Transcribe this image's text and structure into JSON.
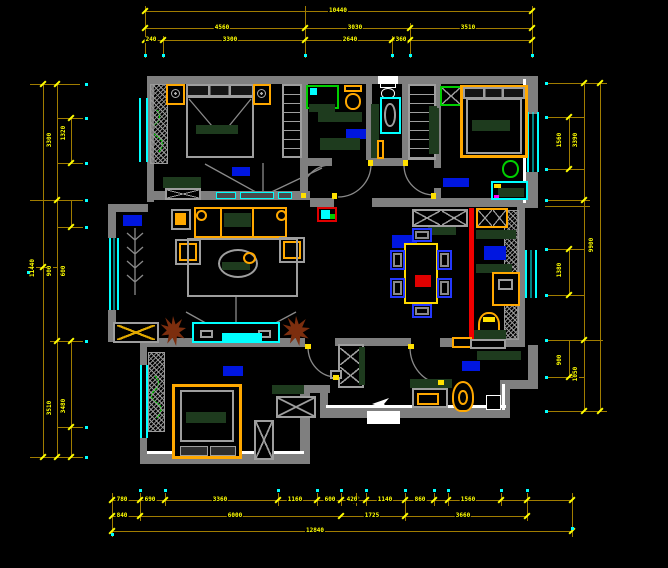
{
  "drawing": {
    "kind": "apartment floor plan (CAD)",
    "background": "#000000"
  },
  "colors": {
    "wall": "#7f7f7f",
    "window_cyan": "#00ffff",
    "dimension_line": "#a07c00",
    "dimension_text": "#ffff00",
    "furniture_gray": "#9e9e9e",
    "furniture_orange": "#ffa800",
    "accent_green": "#00cf00",
    "dark_green": "#1e3b1e",
    "room_label_blue": "#0016e0",
    "chair_blue": "#2438ff",
    "red": "#f00000",
    "plant_brown": "#7c2e0e",
    "white": "#ffffff"
  },
  "dims": {
    "top": {
      "r1": [
        "10440"
      ],
      "r2": [
        "4560",
        "3030",
        "3510"
      ],
      "r3": [
        "240",
        "3300",
        "2640",
        "360"
      ]
    },
    "bottom": {
      "ra": [
        "780",
        "690",
        "3360",
        "1160",
        "600",
        "420",
        "1140",
        "860",
        "1560"
      ],
      "rb": [
        "840",
        "6000",
        "1725",
        "3660"
      ],
      "rc": [
        "12840"
      ]
    },
    "left": {
      "outer": [
        "11440"
      ],
      "mid": [
        "3300",
        "900",
        "3510"
      ],
      "inner": [
        "1320",
        "600",
        "3480"
      ]
    },
    "right": {
      "outer": [
        "9900"
      ],
      "mid": [
        "3390",
        "1050"
      ],
      "inner": [
        "1560",
        "1380",
        "900"
      ]
    }
  }
}
